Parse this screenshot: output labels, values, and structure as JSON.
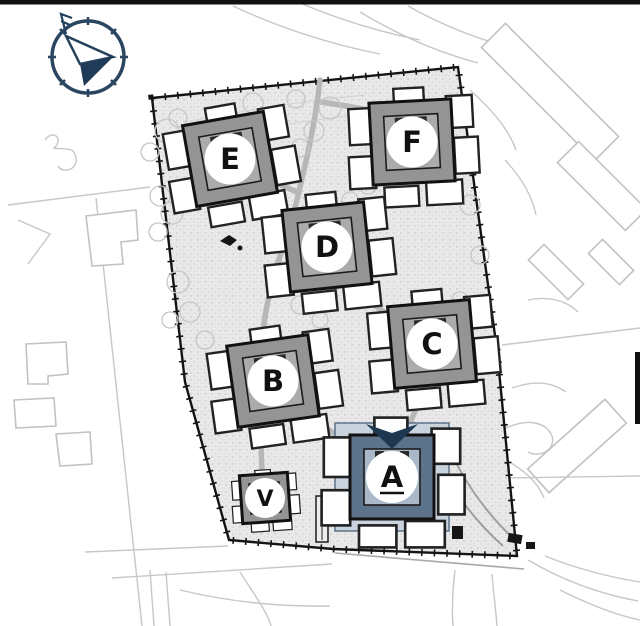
{
  "page": {
    "top_bar_color": "#0c0c0c",
    "background_color": "#ffffff"
  },
  "compass": {
    "icon": "north-arrow-compass",
    "ring_color": "#2b4660",
    "arrow_fill_color": "#1f3b57"
  },
  "site_plan": {
    "ground_color": "#e9e9e9",
    "speckle_color": "#bfbfbf",
    "boundary_color": "#141414",
    "walkway_color": "#b7b7b7",
    "context_line_color": "#c7c7c7",
    "tree_color": "#c6c6c6",
    "building_fill_color": "#949494",
    "building_inner_color": "#ababab",
    "building_outline_color": "#111111",
    "selected_building_fill_color": "#5d7389",
    "selected_building_inner_color": "#a9b9c7",
    "selected_building_plot_color": "#c9d3dd",
    "selected_marker_color": "#1d3850",
    "badge_color": "#ffffff",
    "letter_color": "#111111",
    "buildings": [
      {
        "id": "A",
        "label": "A",
        "selected": true
      },
      {
        "id": "B",
        "label": "B",
        "selected": false
      },
      {
        "id": "C",
        "label": "C",
        "selected": false
      },
      {
        "id": "D",
        "label": "D",
        "selected": false
      },
      {
        "id": "E",
        "label": "E",
        "selected": false
      },
      {
        "id": "F",
        "label": "F",
        "selected": false
      },
      {
        "id": "V",
        "label": "V",
        "selected": false
      }
    ]
  }
}
